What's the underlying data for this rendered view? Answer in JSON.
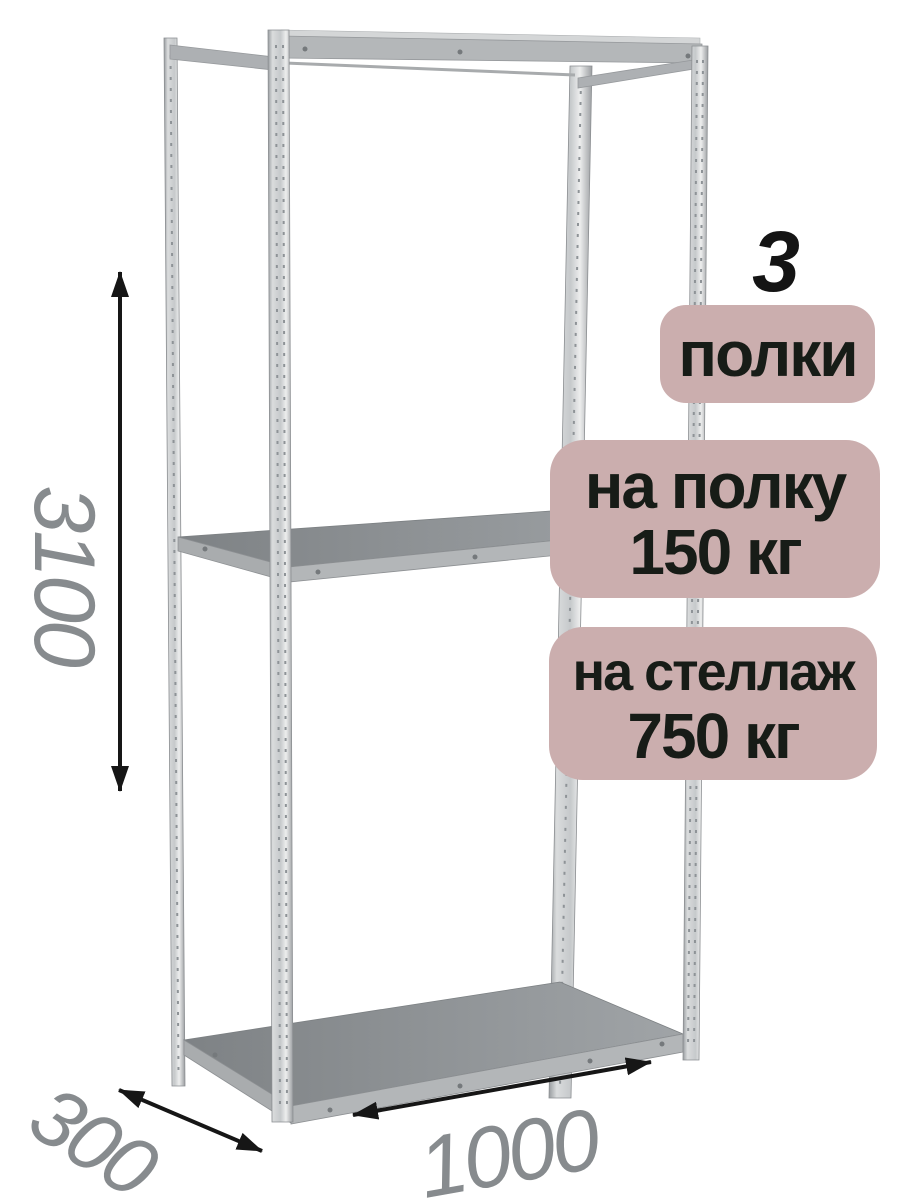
{
  "image": {
    "description": "Metal boltless shelving rack (стеллаж) product illustration with dimension annotations",
    "background": "#ffffff"
  },
  "annotations": {
    "shelves_count": "3",
    "shelves_count_label": "полки",
    "shelf_load_line1": "на полку",
    "shelf_load_line2": "150 кг",
    "rack_load_line1": "на стеллаж",
    "rack_load_line2": "750 кг"
  },
  "dimensions": {
    "height": "3100",
    "depth": "300",
    "width": "1000"
  },
  "colors": {
    "badge_background": "#cbaeae",
    "badge_text": "#171c17",
    "dimension_text": "#878b8e",
    "arrow": "#161616",
    "metal_light": "#dadcdd",
    "metal_mid": "#b4b7b9",
    "metal_dark": "#8f9295",
    "deck_top": "#8c9093"
  }
}
